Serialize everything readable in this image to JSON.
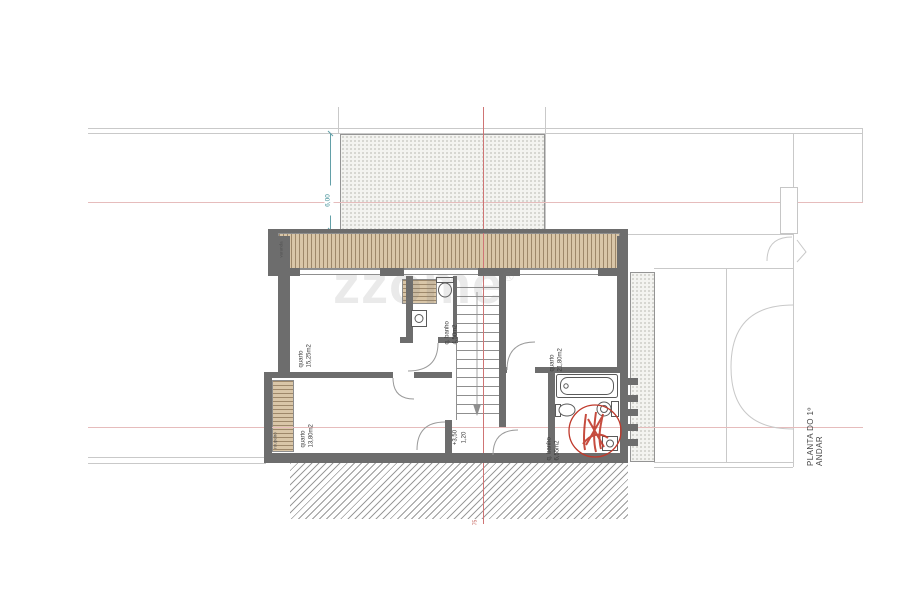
{
  "drawing": {
    "side_label": "PLANTA DO 1º ANDAR",
    "watermark": "zzome",
    "watermark_mark": "®"
  },
  "rooms": {
    "bedroom1": {
      "name": "quarto",
      "area": "15,25m2"
    },
    "bath1": {
      "name": "q. banho",
      "area": "4,50m2"
    },
    "bedroom2": {
      "name": "quarto",
      "area": "21,80m2"
    },
    "bedroom3": {
      "name": "quarto",
      "area": "13,80m2"
    },
    "bath2": {
      "name": "q. banho",
      "area": "6,55m2"
    },
    "balcony": {
      "name": "varanda"
    },
    "wardrobe": {
      "name": "roupeiro"
    }
  },
  "dimensions": {
    "terrace_depth": "6,00",
    "floor_level": "+3,50",
    "stair_width": "1,20",
    "axis_mark": "75"
  },
  "colors": {
    "wall": "#6d6d6d",
    "wood": "#d9c6a8",
    "guide_pink": "#e6bcbc",
    "axis_red": "#cf7474",
    "dimension_teal": "#63a0a8",
    "stamp_red": "#c0392b"
  }
}
